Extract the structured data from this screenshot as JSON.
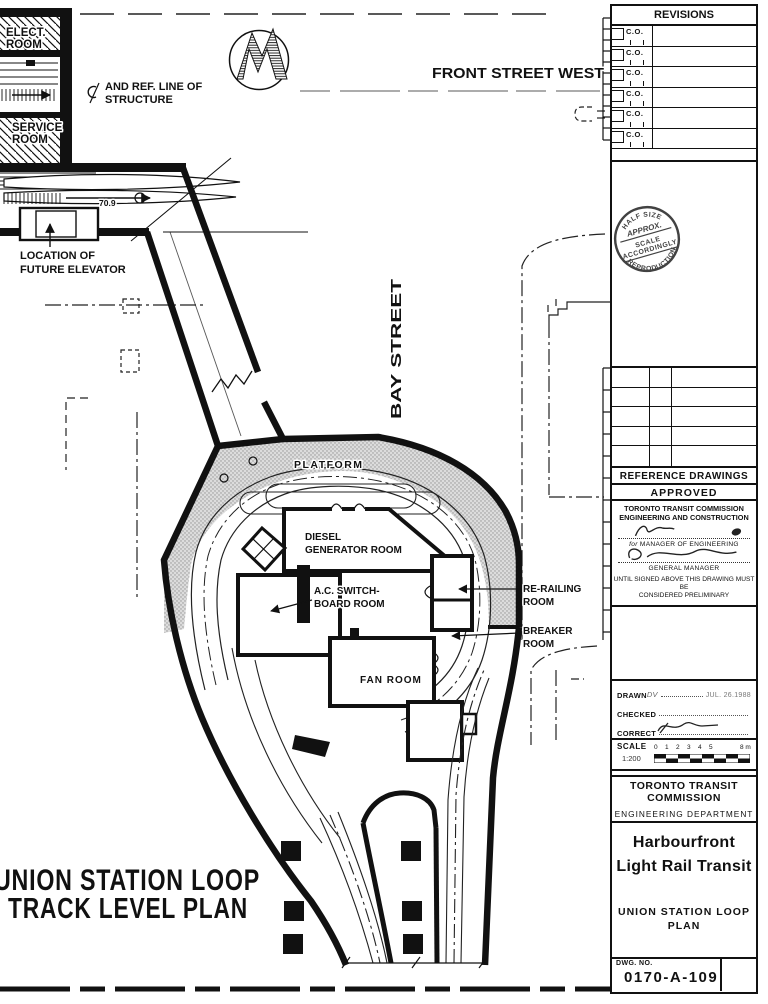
{
  "colors": {
    "ink": "#111111",
    "paper": "#ffffff",
    "platform_fill": "#dcdcdc"
  },
  "plan": {
    "elect_room_line1": "ELECT.",
    "elect_room_line2": "ROOM",
    "service_room_line1": "SERVICE",
    "service_room_line2": "ROOM",
    "ref_line_label_line1": "AND REF. LINE OF",
    "ref_line_label_line2": "STRUCTURE",
    "front_street": "FRONT STREET WEST",
    "bay_street": "BAY STREET",
    "spot_elevation": "70.9",
    "elevator_label_line1": "LOCATION OF",
    "elevator_label_line2": "FUTURE ELEVATOR",
    "platform": "PLATFORM",
    "diesel_line1": "DIESEL",
    "diesel_line2": "GENERATOR ROOM",
    "switchboard_line1": "A.C. SWITCH-",
    "switchboard_line2": "BOARD ROOM",
    "rerailing_line1": "RE-RAILING",
    "rerailing_line2": "ROOM",
    "breaker_line1": "BREAKER",
    "breaker_line2": "ROOM",
    "fan_room": "FAN ROOM",
    "big_title_line1": "UNION STATION LOOP",
    "big_title_line2": "TRACK LEVEL PLAN"
  },
  "titleblock": {
    "revisions": {
      "header": "REVISIONS",
      "rows": [
        "C.O.",
        "C.O.",
        "C.O.",
        "C.O.",
        "C.O.",
        "C.O."
      ]
    },
    "stamp": {
      "top": "HALF SIZE",
      "approx": "APPROX.",
      "mid1": "SCALE",
      "mid2": "ACCORDINGLY",
      "bottom": "REPRODUCTION"
    },
    "reference_header": "REFERENCE DRAWINGS",
    "approved": {
      "header": "APPROVED",
      "org_line1": "TORONTO TRANSIT COMMISSION",
      "org_line2": "ENGINEERING AND CONSTRUCTION",
      "sig1_prefix": "for",
      "sig1_role": "MANAGER OF ENGINEERING",
      "sig2_role": "GENERAL MANAGER",
      "note_line1": "UNTIL SIGNED ABOVE THIS DRAWING MUST BE",
      "note_line2": "CONSIDERED PRELIMINARY"
    },
    "issue": {
      "drawn_label": "DRAWN",
      "drawn_value": "DV",
      "drawn_date": "JUL. 26.1988",
      "checked_label": "CHECKED",
      "correct_label": "CORRECT"
    },
    "scale": {
      "label": "SCALE",
      "ratio": "1:200",
      "ticks": [
        "0",
        "1",
        "2",
        "3",
        "4",
        "5"
      ],
      "end_label": "8 m"
    },
    "org": {
      "line1": "TORONTO TRANSIT",
      "line2": "COMMISSION",
      "dept": "ENGINEERING DEPARTMENT"
    },
    "project": {
      "line1": "Harbourfront",
      "line2": "Light Rail Transit"
    },
    "sheet_title": {
      "line1": "UNION STATION LOOP",
      "line2": "PLAN"
    },
    "dwg": {
      "label": "DWG. NO.",
      "number": "0170-A-109"
    }
  }
}
